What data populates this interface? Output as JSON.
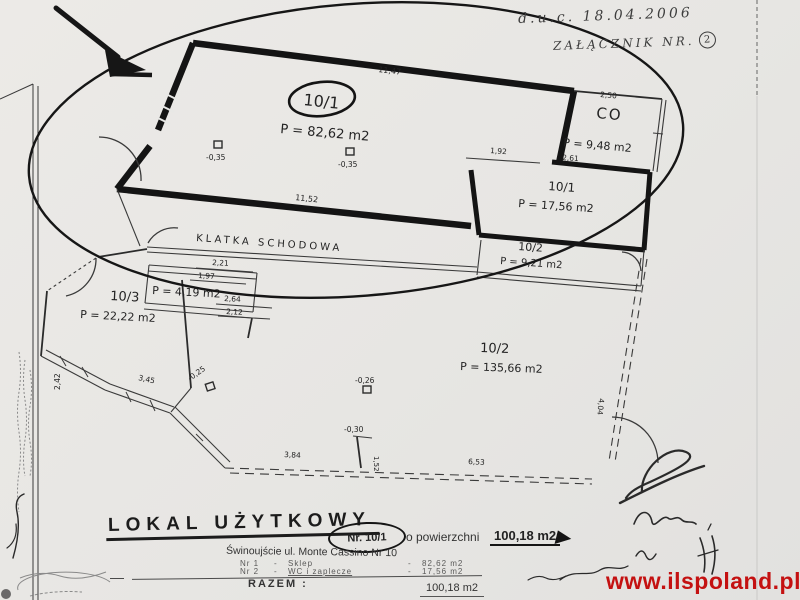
{
  "scan": {
    "handwriting": {
      "date_line": "d.u.c. 18.04.2006",
      "attachment_line": "ZAŁĄCZNIK NR.",
      "attachment_number": "2"
    },
    "watermark": {
      "text": "www.ilspoland.pl",
      "color": "#c41111"
    }
  },
  "plan": {
    "corridor_label": "KLATKA SCHODOWA",
    "rooms": {
      "shop": {
        "id": "10/1",
        "area": "P = 82,62 m2"
      },
      "co": {
        "id": "CO",
        "area": "P = 9,48 m2"
      },
      "wc": {
        "id": "10/1",
        "area": "P = 17,56 m2"
      },
      "small2": {
        "id": "10/2",
        "area": "P = 9,21 m2"
      },
      "vest": {
        "area": "P = 4,19 m2"
      },
      "r103": {
        "id": "10/3",
        "area": "P = 22,22 m2"
      },
      "big2": {
        "id": "10/2",
        "area": "P = 135,66 m2"
      }
    },
    "dimensions": [
      "11,47",
      "2,50",
      "1,92",
      "2,61",
      "11,52",
      "2,21",
      "1,97",
      "2,64",
      "2,12",
      "3,45",
      "2,42",
      "3,84",
      "6,53",
      "4,04",
      "1,52"
    ],
    "level_marks": [
      "-0,35",
      "-0,35",
      "-0,25",
      "-0,26",
      "-0,30"
    ]
  },
  "footer": {
    "title": "LOKAL UŻYTKOWY",
    "unit_no": "Nr. 10/1",
    "area_text": "o powierzchni",
    "area_value": "100,18 m2",
    "address": "Świnoujście ul. Monte Cassino Nr 10",
    "table": {
      "rows": [
        {
          "no": "Nr 1",
          "name": "Sklep",
          "value": "82,62 m2"
        },
        {
          "no": "Nr 2",
          "name": "WC i zaplecze",
          "value": "17,56 m2"
        }
      ],
      "total_label": "RAZEM :",
      "total_value": "100,18 m2"
    }
  }
}
